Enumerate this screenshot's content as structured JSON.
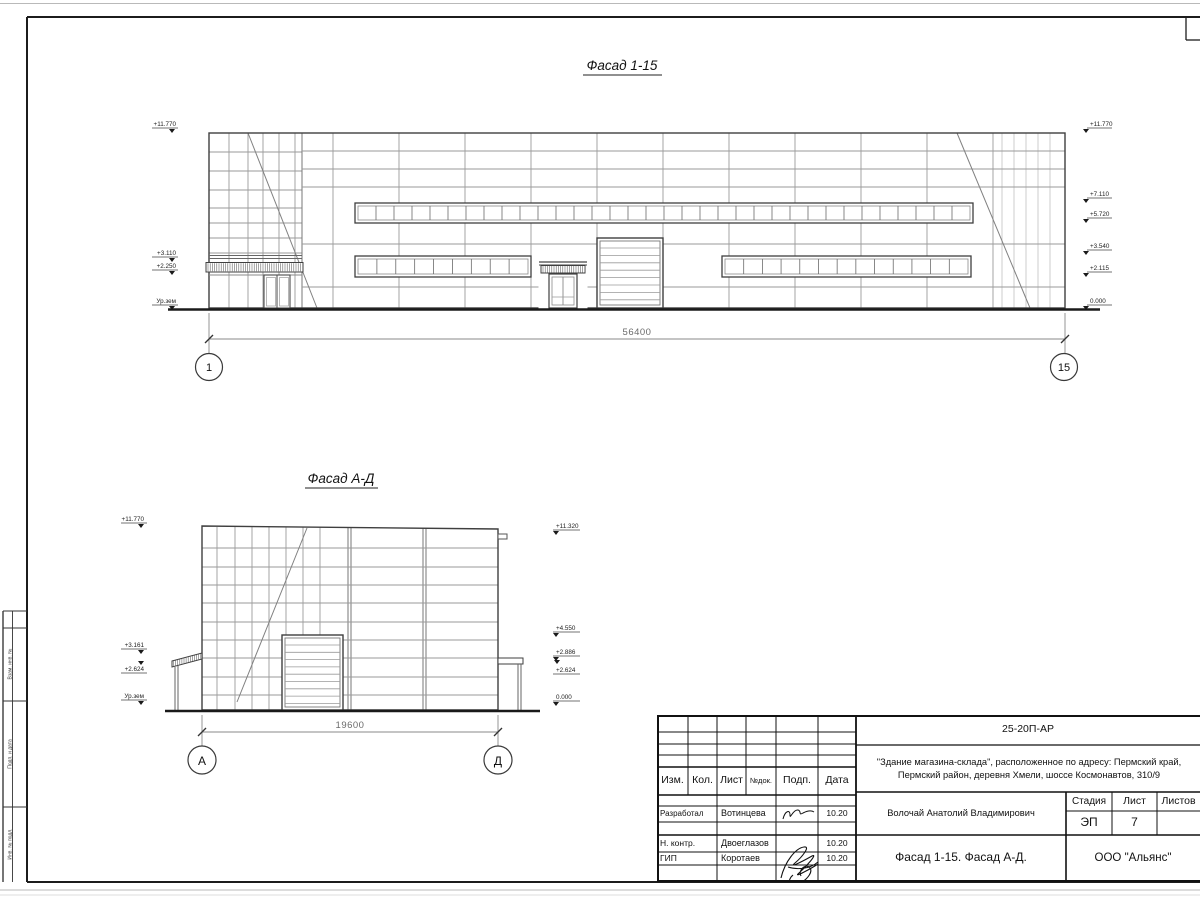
{
  "facade1": {
    "title": "Фасад 1-15",
    "left_marks": [
      "+11.770",
      "+3.110",
      "+2.250",
      "Ур.зем"
    ],
    "right_marks": [
      "+11.770",
      "+7.110",
      "+5.720",
      "+3.540",
      "+2.115",
      "0.000"
    ],
    "dimension": "56400",
    "axis_start": "1",
    "axis_end": "15"
  },
  "facade2": {
    "title": "Фасад А-Д",
    "left_marks": [
      "+11.770",
      "+3.161",
      "+2.624",
      "Ур.зем"
    ],
    "right_marks": [
      "+11.320",
      "+4.550",
      "+2.886",
      "+2.624",
      "0.000"
    ],
    "dimension": "19600",
    "axis_start": "А",
    "axis_end": "Д"
  },
  "side_stamp": {
    "labels": [
      "Взам. инв. №",
      "Подп. и дата",
      "Инв. № подл."
    ]
  },
  "title_block": {
    "doc_code": "25-20П-АР",
    "project_line1": "\"Здание магазина-склада\", расположенное по адресу: Пермский край,",
    "project_line2": "Пермский район, деревня Хмели, шоссе Космонавтов, 310/9",
    "col_izm": "Изм.",
    "col_kol": "Кол.",
    "col_list": "Лист",
    "col_ndok": "№док.",
    "col_podp": "Подп.",
    "col_data": "Дата",
    "row_developed_label": "Разработал",
    "row_developed_name": "Вотинцева",
    "row_developed_date": "10.20",
    "row_ncontr_label": "Н. контр.",
    "row_ncontr_name": "Двоеглазов",
    "row_ncontr_date": "10.20",
    "row_gip_label": "ГИП",
    "row_gip_name": "Коротаев",
    "row_gip_date": "10.20",
    "author": "Волочай Анатолий Владимирович",
    "stage_label": "Стадия",
    "sheet_label": "Лист",
    "sheets_label": "Листов",
    "stage_value": "ЭП",
    "sheet_value": "7",
    "sheet_title": "Фасад 1-15. Фасад А-Д.",
    "company": "ООО \"Альянс\""
  }
}
